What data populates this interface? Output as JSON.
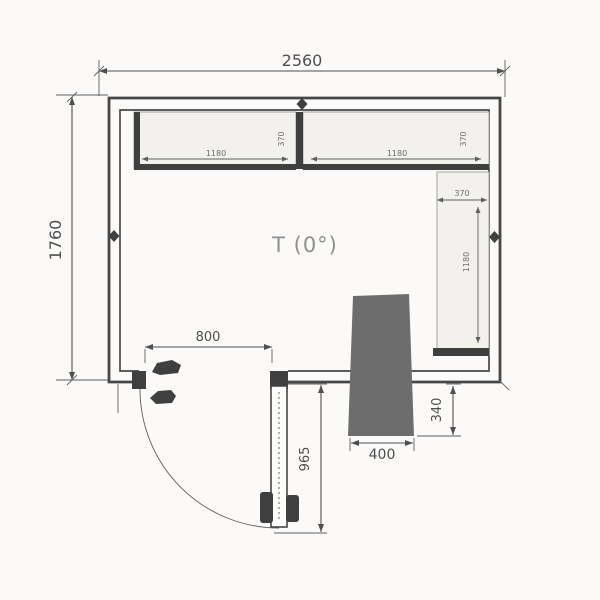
{
  "drawing": {
    "kind": "cold-room floor plan",
    "labels": {
      "room_temp": "T (0°)",
      "overall_width": "2560",
      "overall_depth": "1760",
      "door_opening_width": "800",
      "door_leaf_length": "965",
      "unit_width": "400",
      "unit_protrusion": "340",
      "top_shelf_left": {
        "length": "1180",
        "depth": "370"
      },
      "top_shelf_right": {
        "length": "1180",
        "depth": "370"
      },
      "side_shelf": {
        "depth": "370",
        "length": "1180"
      }
    },
    "colors": {
      "background": "#fbfaf8",
      "unit_fill": "#6d6d6d",
      "wall_line": "#474747",
      "dimension_line": "#4f4f4f",
      "shelf_fill": "#f2f1ee",
      "text": "#545454",
      "room_label_text": "#8f8f8f"
    }
  }
}
